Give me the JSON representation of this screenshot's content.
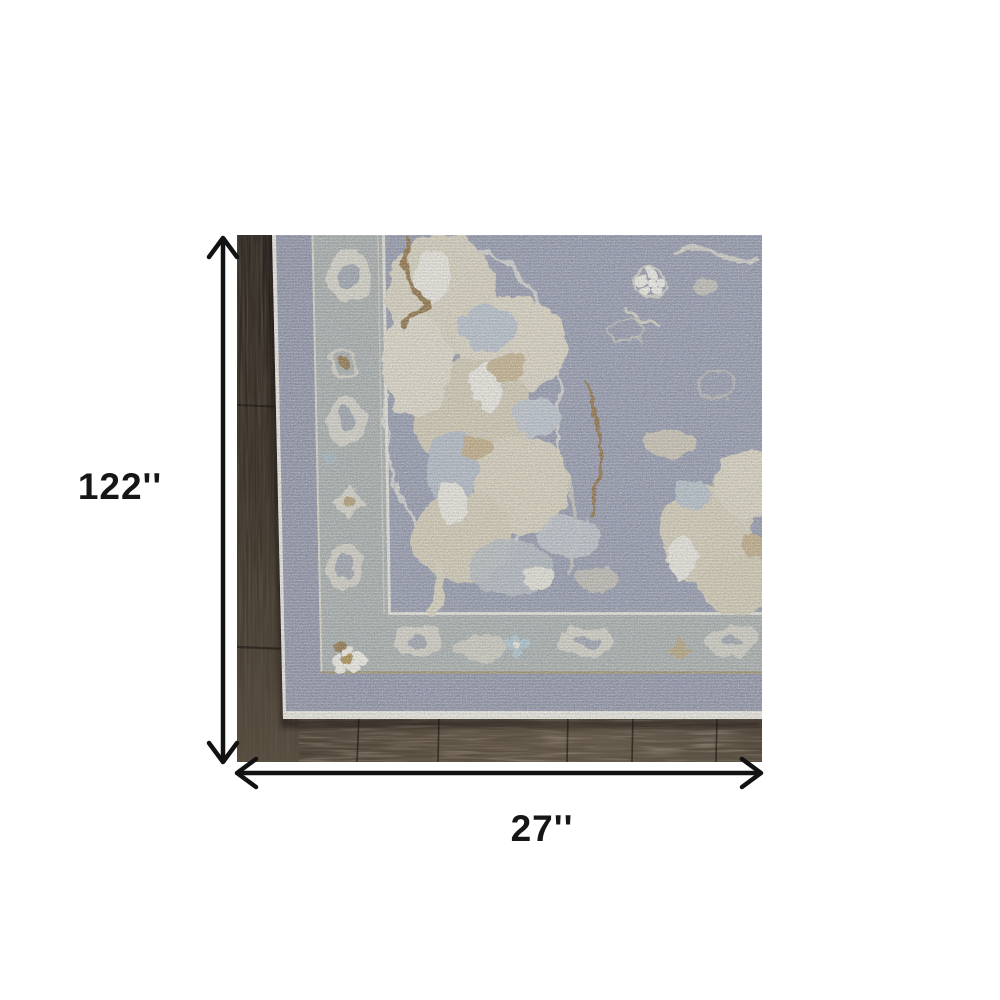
{
  "figure": {
    "type": "product-dimension-image",
    "subject": "corner of a distressed grey and ivory oriental area rug lying on dark wood flooring"
  },
  "dimensions": {
    "height_label": "122''",
    "width_label": "27''"
  },
  "palette": {
    "background": "#ffffff",
    "arrow": "#121212",
    "label_text": "#161616",
    "rug_field": "#8f94a6",
    "rug_border_band": "#a4aaa6",
    "rug_outer_band": "#8a8ea0",
    "rug_binding": "#eae7dc",
    "guard_line_ivory": "#e7e4d5",
    "guard_line_tan": "#9a8c5e",
    "motif_ivory": "#e8e5d8",
    "motif_cream": "#d5ceb7",
    "motif_tan": "#c3ae85",
    "motif_gold_brown": "#8c6e3e",
    "motif_blue_grey": "#b4bcc4",
    "floor_dark": "#332b23",
    "floor_light": "#5d5143"
  }
}
